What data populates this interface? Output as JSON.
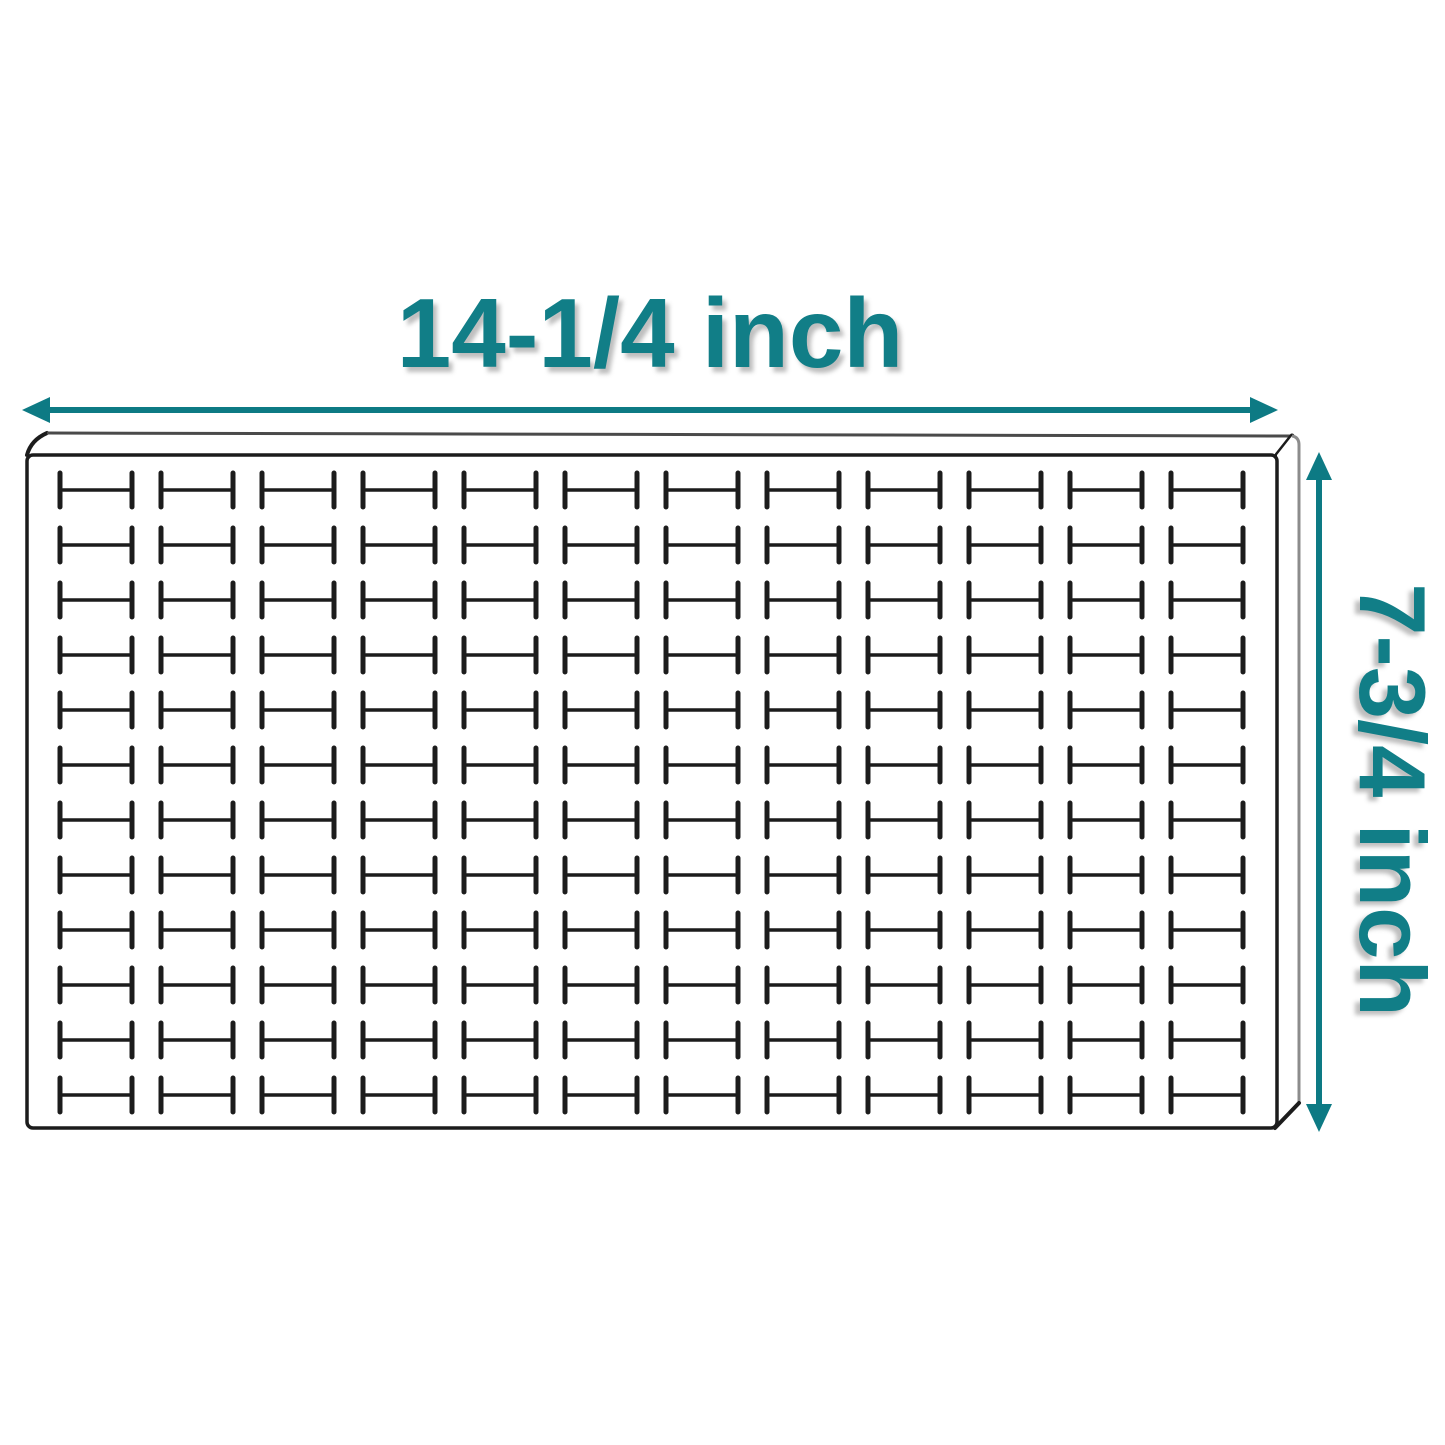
{
  "labels": {
    "width": "14-1/4 inch",
    "height": "7-3/4 inch"
  },
  "diagram": {
    "type": "product-dimension-diagram",
    "subject": "tray insert with H-shaped slots",
    "grid": {
      "rows": 12,
      "cols": 12,
      "total_slots": 144,
      "slot_shape": "H"
    },
    "dimensions": {
      "width": "14-1/4 inch",
      "height": "7-3/4 inch"
    },
    "colors": {
      "accent_teal": "#117e87",
      "arrow_teal": "#0d7a84",
      "outline_black": "#1c1c1c",
      "edge_gray": "#8c8c8c",
      "background": "#ffffff"
    }
  }
}
